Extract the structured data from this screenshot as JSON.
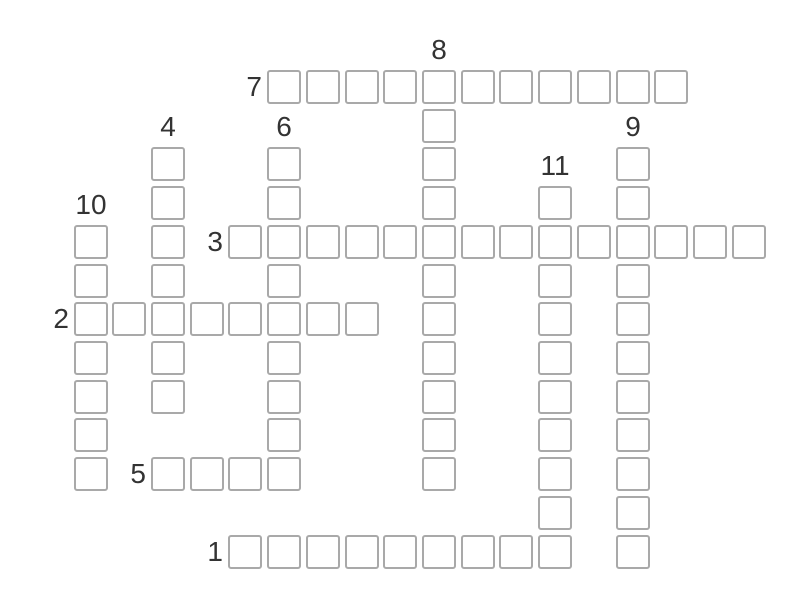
{
  "colors": {
    "page_background": "#ffffff",
    "cell_background": "#ffffff",
    "cell_border": "#a9a9a9",
    "number_ink": "#333333"
  },
  "puzzle": {
    "kind": "crossword-grid",
    "entries": [
      {
        "number": "7",
        "direction": "across",
        "col": 5,
        "row": 0,
        "length": 11
      },
      {
        "number": "8",
        "direction": "down",
        "col": 9,
        "row": 0,
        "length": 11
      },
      {
        "number": "4",
        "direction": "down",
        "col": 2,
        "row": 2,
        "length": 7
      },
      {
        "number": "6",
        "direction": "down",
        "col": 5,
        "row": 2,
        "length": 9
      },
      {
        "number": "9",
        "direction": "down",
        "col": 14,
        "row": 2,
        "length": 11
      },
      {
        "number": "11",
        "direction": "down",
        "col": 12,
        "row": 3,
        "length": 10
      },
      {
        "number": "10",
        "direction": "down",
        "col": 0,
        "row": 4,
        "length": 7
      },
      {
        "number": "3",
        "direction": "across",
        "col": 4,
        "row": 4,
        "length": 14
      },
      {
        "number": "2",
        "direction": "across",
        "col": 0,
        "row": 6,
        "length": 8
      },
      {
        "number": "5",
        "direction": "across",
        "col": 2,
        "row": 10,
        "length": 4
      },
      {
        "number": "1",
        "direction": "across",
        "col": 4,
        "row": 12,
        "length": 9
      }
    ]
  }
}
